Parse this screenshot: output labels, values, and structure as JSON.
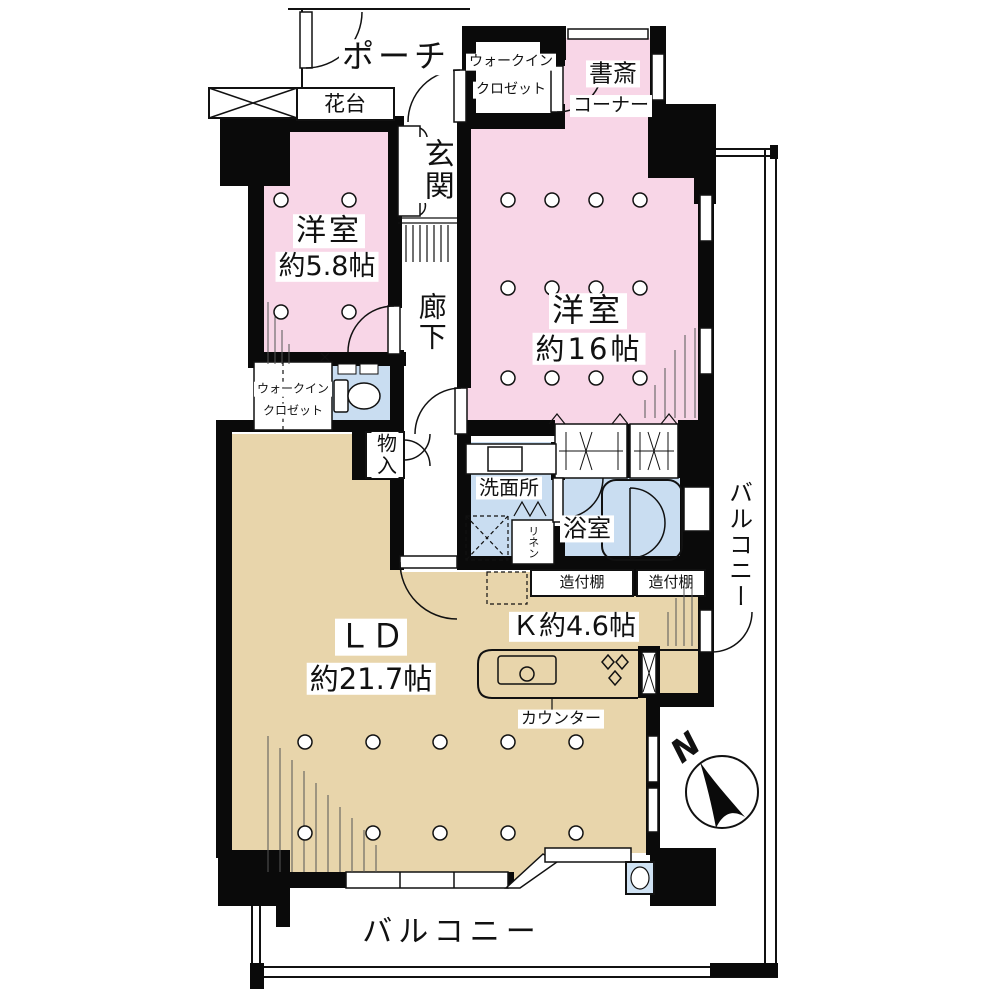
{
  "colors": {
    "wall": "#0a0a0a",
    "bedroom": "#f8d6e7",
    "living": "#e8d5ab",
    "wet": "#c9ddf1",
    "fixture": "#cfe2f3",
    "line": "#111111"
  },
  "rooms": {
    "porch": {
      "label": "ポーチ"
    },
    "flower_stand": {
      "label": "花台"
    },
    "wic_top": {
      "line1": "ウォークイン",
      "line2": "クロゼット"
    },
    "study": {
      "line1": "書斎",
      "line2": "コーナー"
    },
    "entrance": {
      "label": "玄関"
    },
    "bedroom_58": {
      "line1": "洋室",
      "line2": "約5.8帖"
    },
    "corridor": {
      "label": "廊下"
    },
    "bedroom_16": {
      "line1": "洋室",
      "line2": "約16帖"
    },
    "wic_left": {
      "line1": "ウォークイン",
      "line2": "クロゼット"
    },
    "storage": {
      "label": "物入"
    },
    "washroom": {
      "label": "洗面所"
    },
    "linen": {
      "label": "リネン"
    },
    "bathroom": {
      "label": "浴室"
    },
    "shelf_left": {
      "label": "造付棚"
    },
    "shelf_right": {
      "label": "造付棚"
    },
    "kitchen": {
      "label": "Ｋ約4.6帖"
    },
    "living_dining": {
      "line1": "ＬＤ",
      "line2": "約21.7帖"
    },
    "counter": {
      "label": "カウンター"
    },
    "balcony_right": {
      "label": "バルコニー"
    },
    "balcony_bottom": {
      "label": "バルコニー"
    }
  },
  "compass": {
    "north_label": "N"
  }
}
